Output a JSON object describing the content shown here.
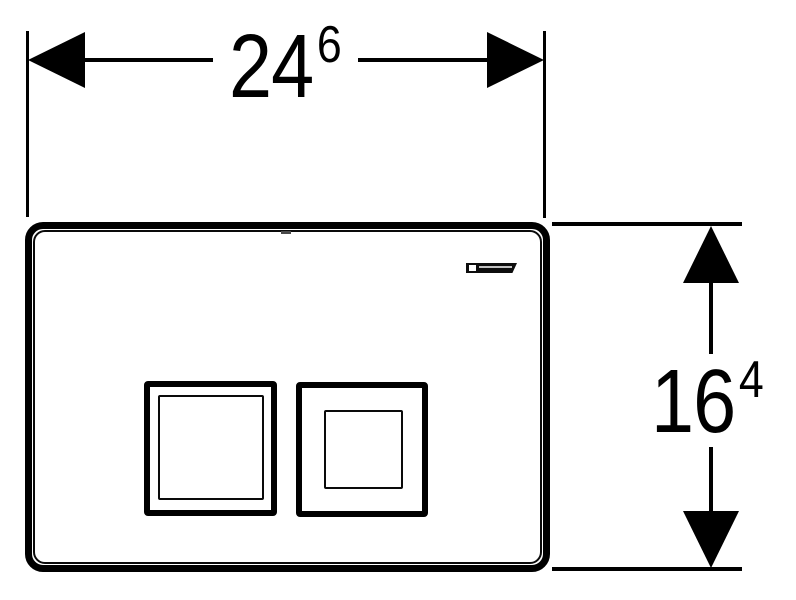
{
  "page": {
    "background_color": "#ffffff",
    "ink_color": "#000000",
    "subject": "flush-plate-front-view-dimension-drawing"
  },
  "dimension_width": {
    "main": "24",
    "sup": "6"
  },
  "dimension_height": {
    "main": "16",
    "sup": "4"
  },
  "icons": {
    "dim_width_left": "arrowhead-left-icon",
    "dim_width_right": "arrowhead-right-icon",
    "dim_height_up": "arrowhead-up-icon",
    "dim_height_down": "arrowhead-down-icon",
    "plate_logo": "geberit-logo-icon"
  }
}
